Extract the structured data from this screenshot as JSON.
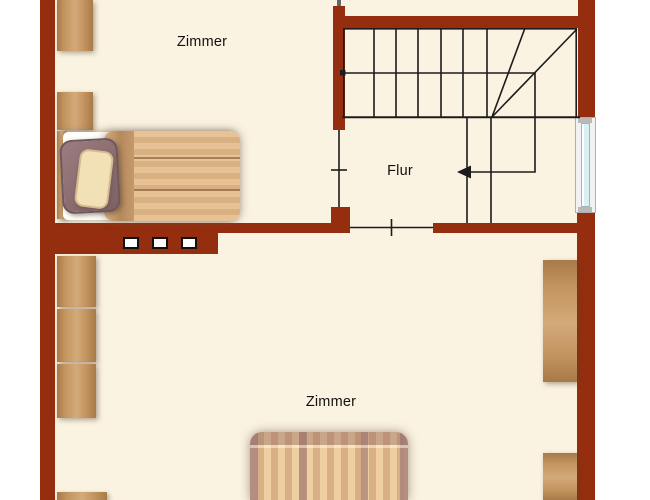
{
  "rooms": [
    {
      "id": "zimmer-top",
      "label": "Zimmer"
    },
    {
      "id": "flur",
      "label": "Flur"
    },
    {
      "id": "zimmer-bottom",
      "label": "Zimmer"
    }
  ],
  "stairs": {
    "walk_arrow_icon": "arrow-left",
    "straight_treads": 6,
    "winder_treads": 2
  },
  "colors": {
    "wall": "#952E0E",
    "floor": "#FAF3E1",
    "outside": "#FFFFFF",
    "plan_line": "#1C1C1C",
    "window_glass": "#D9F1F3",
    "window_frame": "#F2F2F2",
    "wood_light": "#D4AA7A",
    "wood_mid": "#C2945F",
    "wood_dark": "#A87A48",
    "bedding_cream": "#EECFA2",
    "bedding_tan": "#D9AF85",
    "pillow_mauve": "#927478",
    "pillow_cream": "#F2E0B6"
  }
}
